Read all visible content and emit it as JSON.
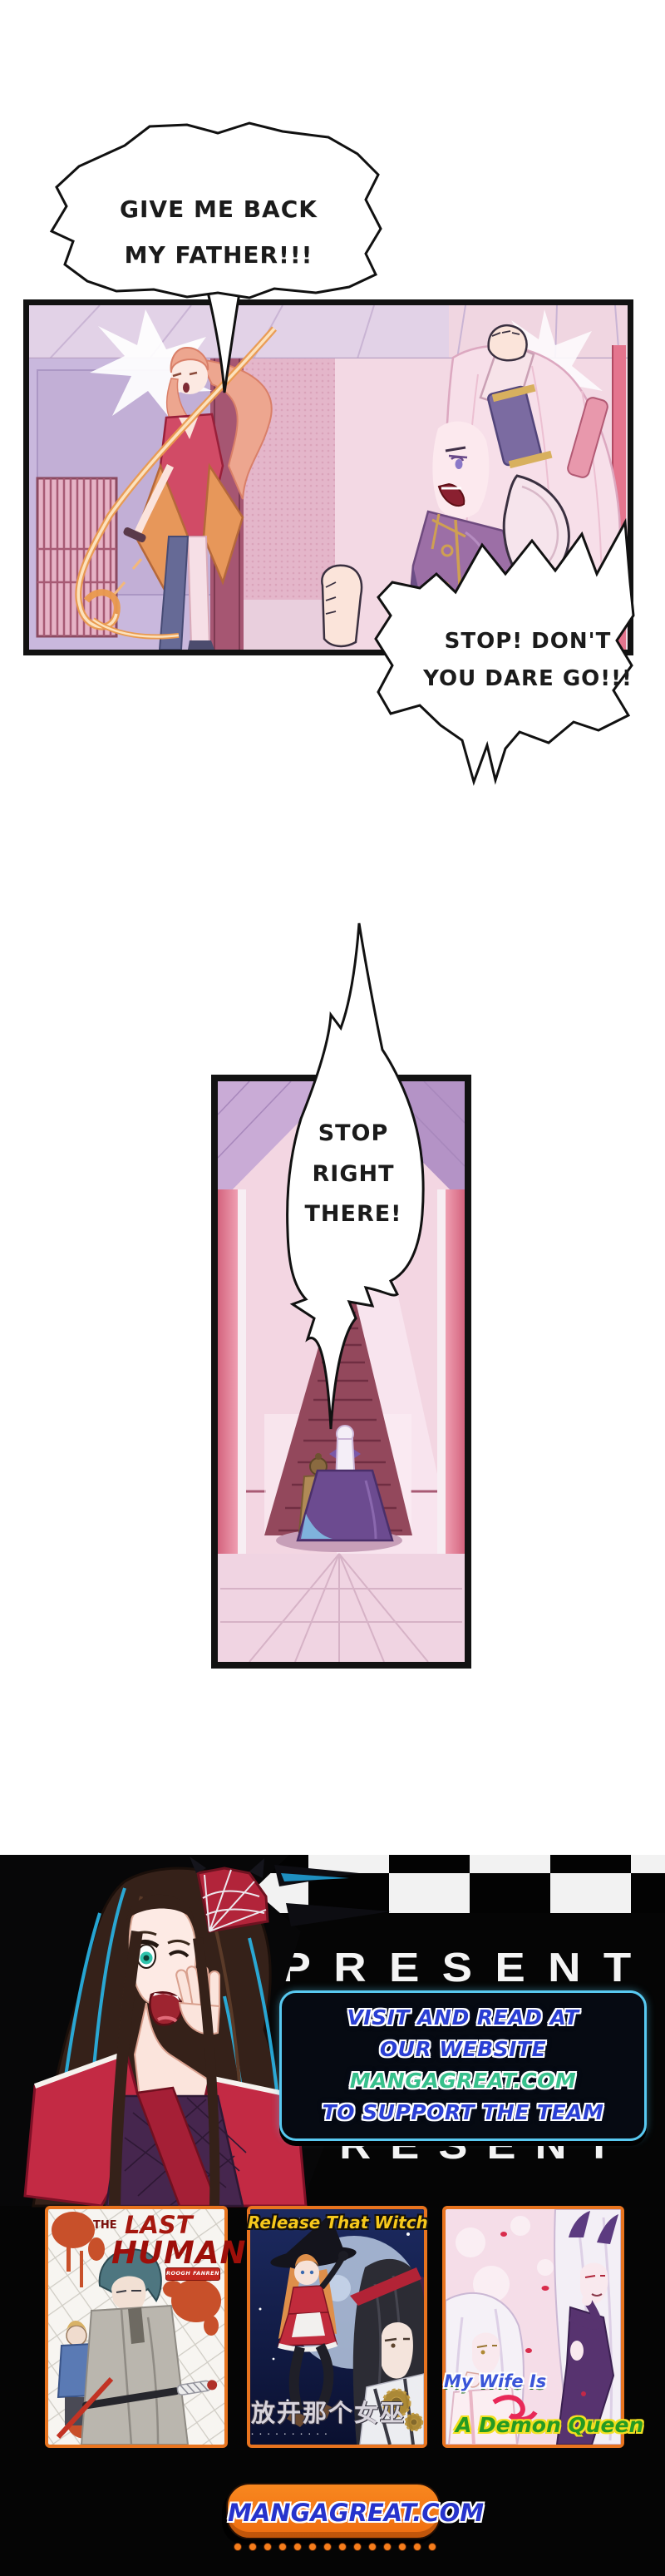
{
  "comic": {
    "bubble1": {
      "line1": "GIVE ME BACK",
      "line2": "MY FATHER!!!"
    },
    "bubble2": {
      "line1": "STOP! DON'T",
      "line2": "YOU DARE GO!!!"
    },
    "bubble3": {
      "line1": "STOP",
      "line2": "RIGHT",
      "line3": "THERE!"
    }
  },
  "footer": {
    "present_label": "PRESENT",
    "promo_box": {
      "line1": "VISIT AND READ AT",
      "line2": "OUR WEBSITE",
      "line3": "MANGAGREAT.COM",
      "line4": "TO SUPPORT THE TEAM"
    },
    "site_button": {
      "label": "MANGAGREAT.COM"
    },
    "covers": {
      "cover1": {
        "title_the": "THE",
        "title_last": "LAST",
        "title_human": "HUMAN",
        "badge": "ROOGH FANREN"
      },
      "cover2": {
        "title": "Release That Witch",
        "subtitle_cn": "放开那个女巫",
        "subtitle_small": "· · · · · · · · · ·"
      },
      "cover3": {
        "line1": "My Wife Is",
        "line2": "A Demon Queen"
      }
    },
    "colors": {
      "accent_orange": "#f57a1a",
      "promo_blue": "#2a3fd4",
      "promo_green": "#37c08c",
      "box_border": "#57c8f0",
      "button_text": "#2633cc",
      "checker_white": "#f2f2f2"
    }
  }
}
